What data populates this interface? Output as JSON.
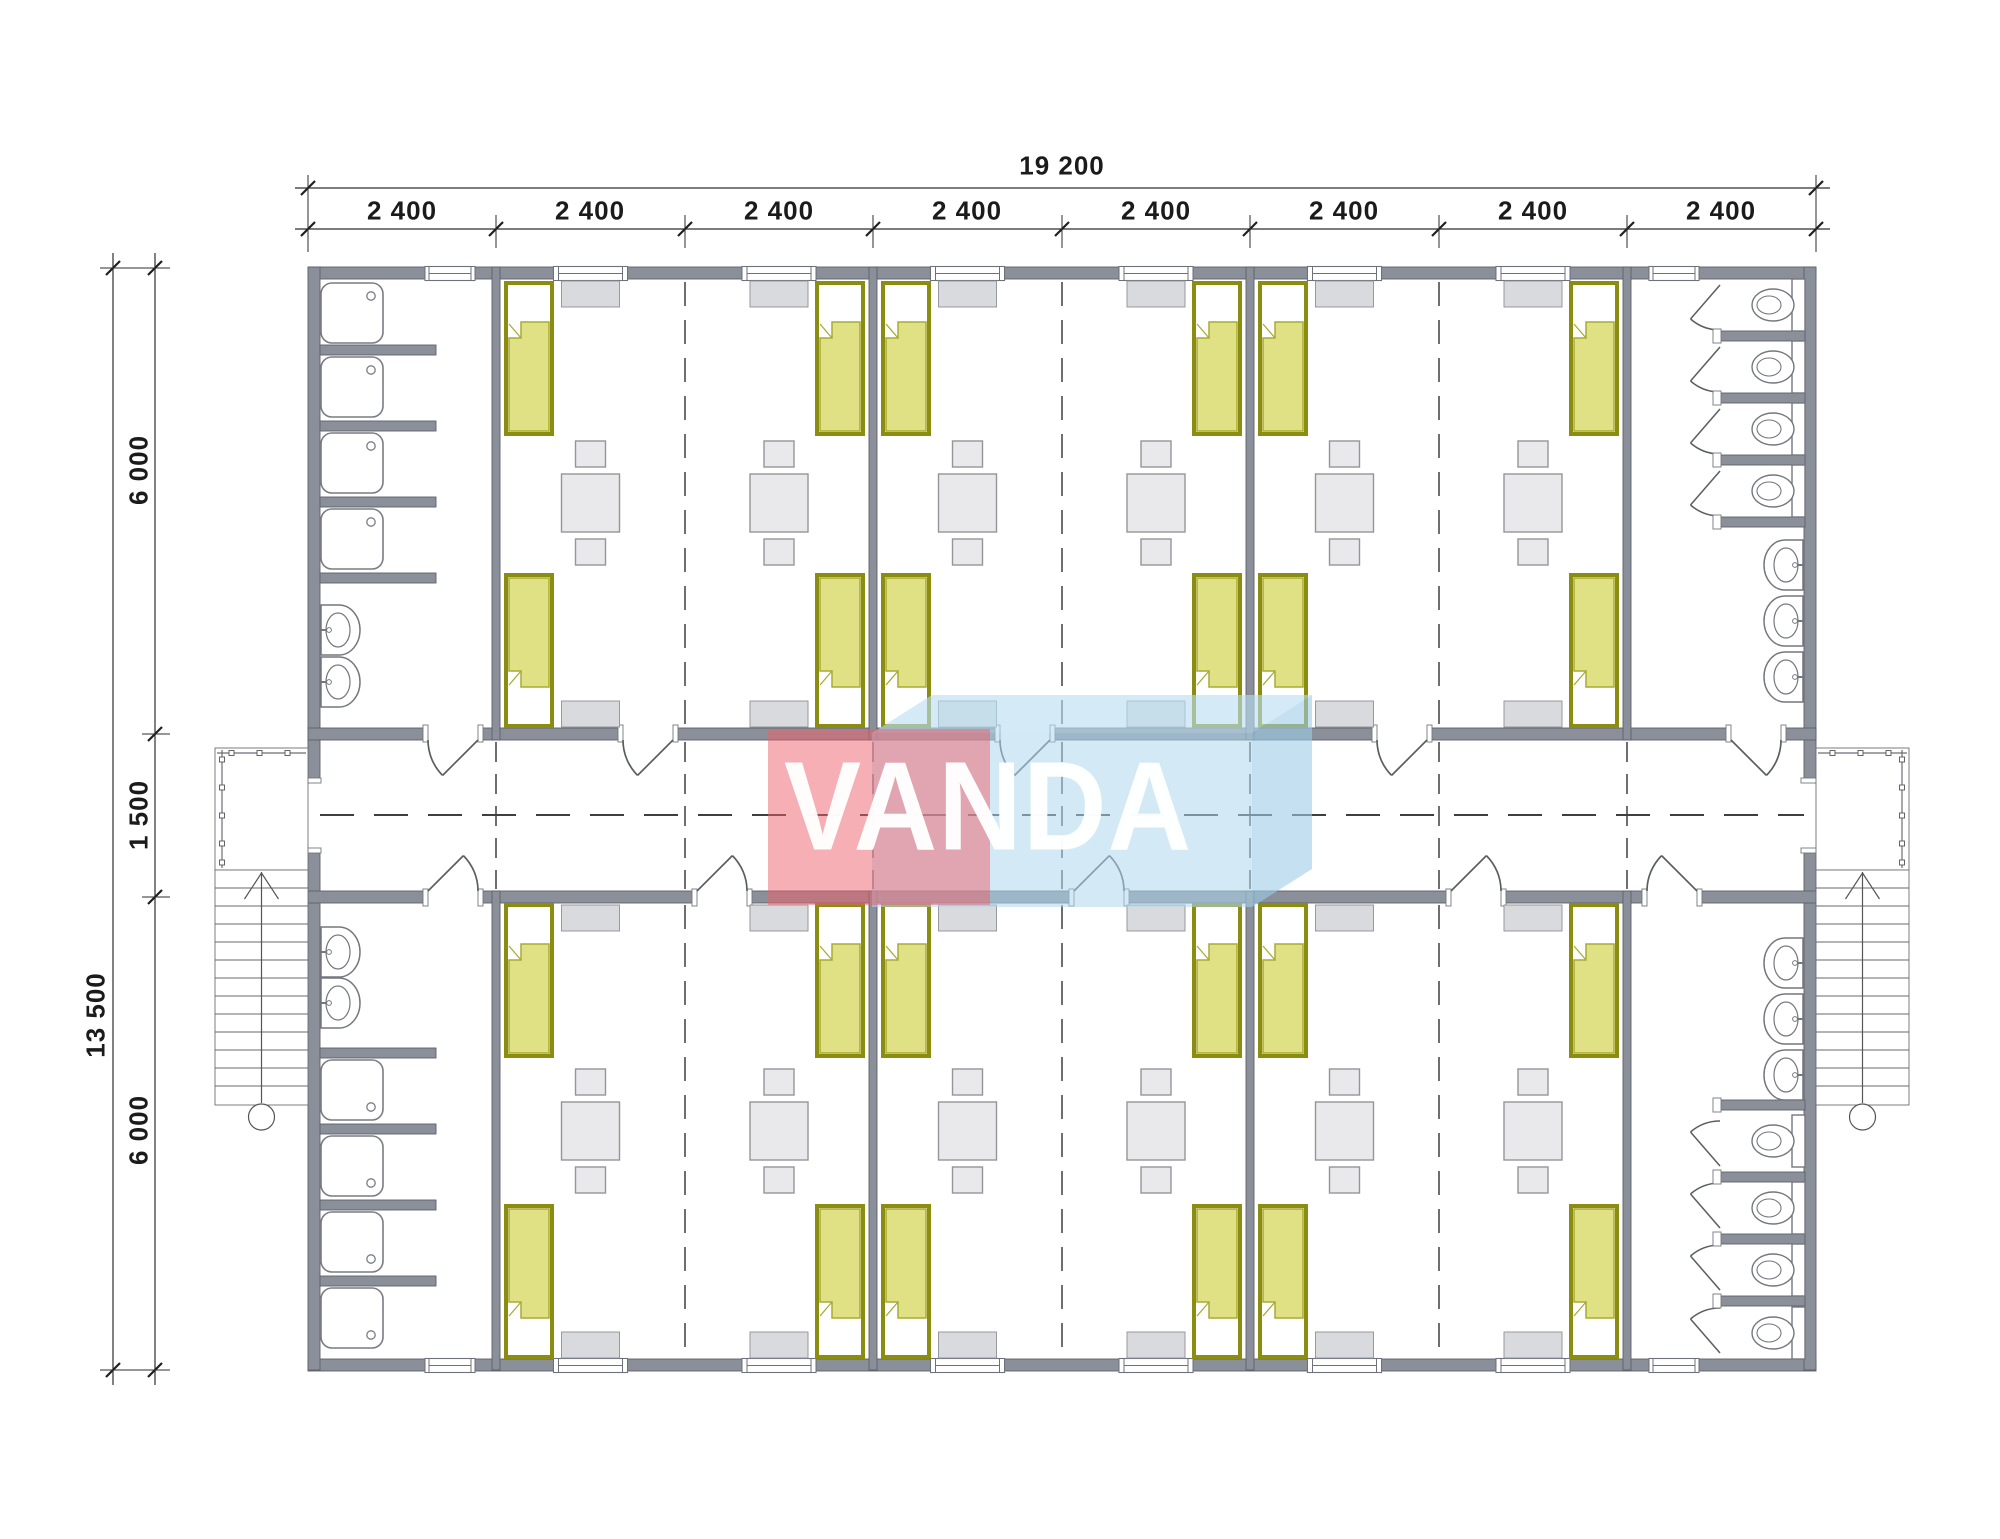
{
  "watermark": {
    "text": "VANDA",
    "red_color": "#ed5f6a",
    "blue_color": "#aed8ee"
  },
  "dimensions": {
    "total_width_label": "19 200",
    "module_labels": [
      "2 400",
      "2 400",
      "2 400",
      "2 400",
      "2 400",
      "2 400",
      "2 400",
      "2 400"
    ],
    "total_height_label": "13 500",
    "height_segment_labels": [
      "6 000",
      "1 500",
      "6 000"
    ]
  },
  "plan": {
    "drawing_type": "modular building floor plan",
    "building": {
      "module_count": 8,
      "module_width_mm": 2400,
      "total_width_mm": 19200,
      "total_depth_mm": 13500,
      "room_depth_mm": 6000,
      "corridor_width_mm": 1500
    },
    "top_wing_rooms": [
      {
        "name": "shower room",
        "showers": 4,
        "washbasins": 2
      },
      {
        "name": "bedroom",
        "beds": 4,
        "tables": 2,
        "stools": 4,
        "cabinets": 2,
        "radiators": 2,
        "windows": 2
      },
      {
        "name": "bedroom",
        "beds": 4,
        "tables": 2,
        "stools": 4,
        "cabinets": 2,
        "radiators": 2,
        "windows": 2
      },
      {
        "name": "bedroom",
        "beds": 4,
        "tables": 2,
        "stools": 4,
        "cabinets": 2,
        "radiators": 2,
        "windows": 2
      },
      {
        "name": "toilet room",
        "toilets": 4,
        "washbasins": 3
      }
    ],
    "bottom_wing_rooms": [
      {
        "name": "shower room",
        "showers": 4,
        "washbasins": 2
      },
      {
        "name": "bedroom",
        "beds": 4,
        "tables": 2,
        "stools": 4,
        "cabinets": 2,
        "radiators": 2,
        "windows": 2
      },
      {
        "name": "bedroom",
        "beds": 4,
        "tables": 2,
        "stools": 4,
        "cabinets": 2,
        "radiators": 2,
        "windows": 2
      },
      {
        "name": "bedroom",
        "beds": 4,
        "tables": 2,
        "stools": 4,
        "cabinets": 2,
        "radiators": 2,
        "windows": 2
      },
      {
        "name": "toilet room",
        "toilets": 4,
        "washbasins": 3
      }
    ],
    "exterior": {
      "staircases": 2,
      "entry_porches": 2,
      "entry_doors": 2
    },
    "colors": {
      "wall": "#8a8f99",
      "bed_fill": "#e0e184",
      "bed_frame": "#8a8d10",
      "furniture": "#e9e9ec"
    }
  }
}
